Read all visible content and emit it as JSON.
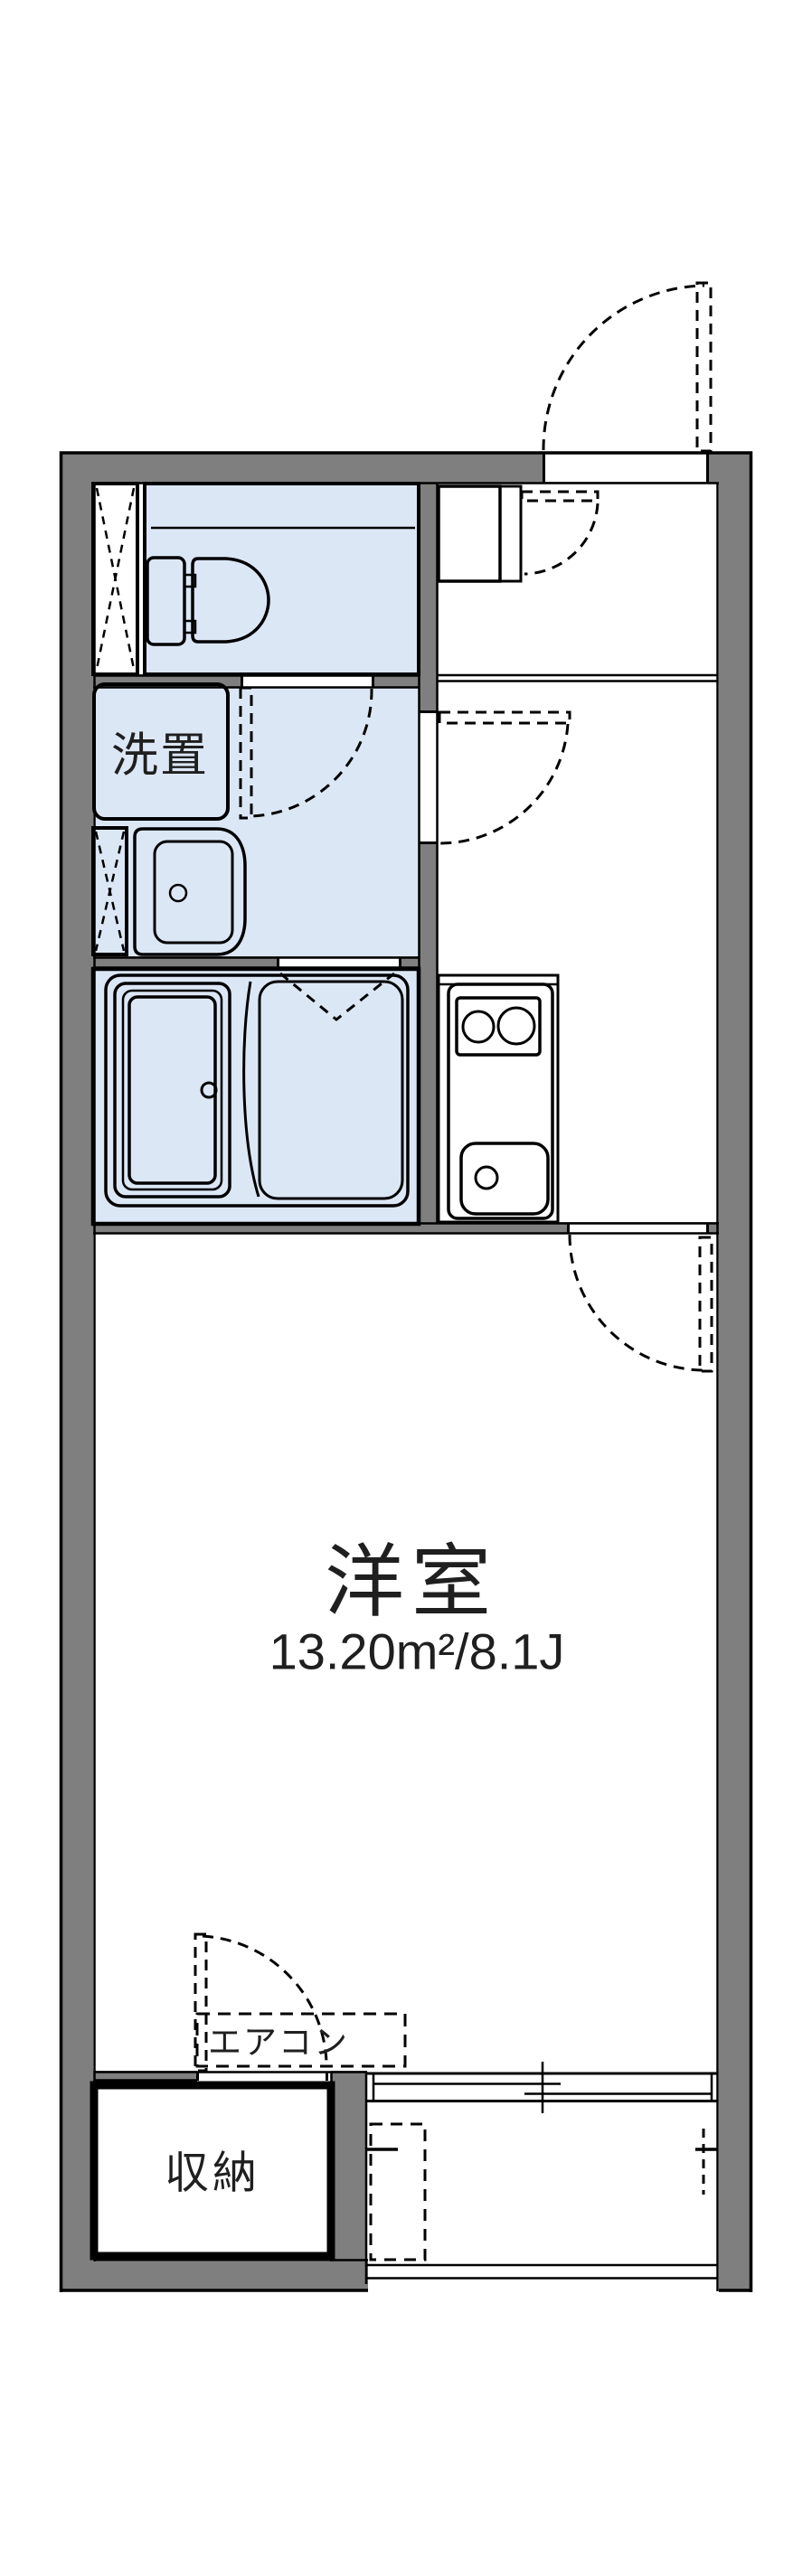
{
  "floor_plan": {
    "labels": {
      "laundry": "洗置",
      "main_room": "洋室",
      "main_room_area": "13.20m²/8.1J",
      "aircon": "エアコン",
      "storage": "収納"
    },
    "rooms": [
      {
        "name": "toilet-room"
      },
      {
        "name": "washroom"
      },
      {
        "name": "bathroom"
      },
      {
        "name": "kitchen-hallway"
      },
      {
        "name": "western-room",
        "label": "洋室",
        "area": "13.20m²/8.1J"
      },
      {
        "name": "storage-closet",
        "label": "収納"
      },
      {
        "name": "balcony"
      }
    ],
    "fixtures": [
      "toilet",
      "washbasin",
      "laundry-pan",
      "bathtub",
      "shower-floor",
      "kitchen-stove",
      "kitchen-sink",
      "shoe-cabinet",
      "air-conditioner",
      "sliding-window"
    ],
    "colors": {
      "wall": "#7f7f7f",
      "wet_room": "#dce7f6",
      "storage_fill": "#fcf0da",
      "line": "#000000",
      "background": "#ffffff"
    }
  }
}
